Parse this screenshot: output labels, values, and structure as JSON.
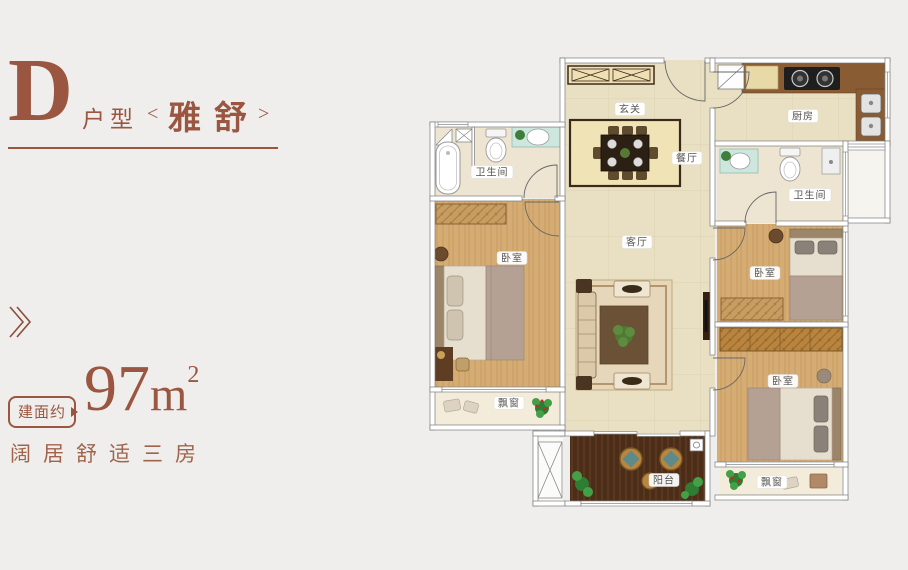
{
  "palette": {
    "accent": "#9a5640",
    "label_text": "#555555",
    "wood_floor": "#d5ad74",
    "tile_floor": "#e9e0c3",
    "deck_floor": "#4b2d18"
  },
  "left_panel": {
    "type_letter": "D",
    "type_word": "户型",
    "bracket_left": "<",
    "name": "雅舒",
    "bracket_right": ">",
    "area_badge": "建面约",
    "area_number": "97",
    "area_unit": "m",
    "area_sup": "2",
    "tagline": "阔居舒适三房",
    "chevron_icon": "double-right-chevron"
  },
  "floorplan": {
    "rooms": [
      {
        "id": "entry",
        "label": "玄关"
      },
      {
        "id": "dining",
        "label": "餐厅"
      },
      {
        "id": "kitchen",
        "label": "厨房"
      },
      {
        "id": "bathroom-1",
        "label": "卫生间"
      },
      {
        "id": "bathroom-2",
        "label": "卫生间"
      },
      {
        "id": "living",
        "label": "客厅"
      },
      {
        "id": "bedroom-1",
        "label": "卧室"
      },
      {
        "id": "bedroom-2",
        "label": "卧室"
      },
      {
        "id": "bedroom-3",
        "label": "卧室"
      },
      {
        "id": "bay-window-1",
        "label": "飘窗"
      },
      {
        "id": "bay-window-2",
        "label": "飘窗"
      },
      {
        "id": "balcony",
        "label": "阳台"
      }
    ]
  }
}
